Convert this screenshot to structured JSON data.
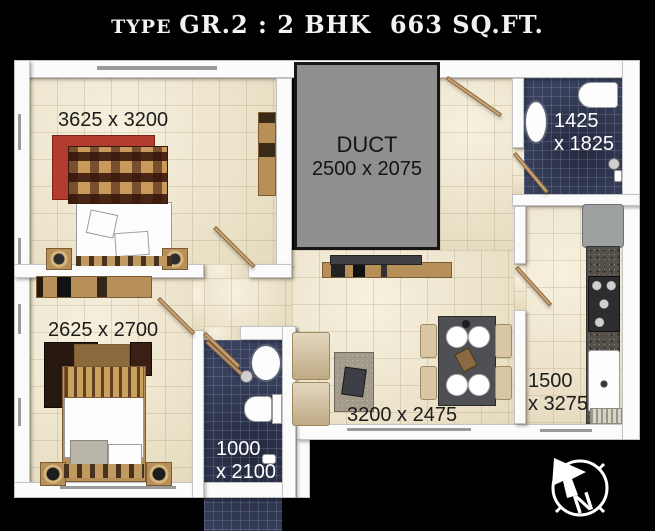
{
  "title": {
    "prefix": "TYPE ",
    "main": "GR.2 : 2 BHK  663 SQ.FT."
  },
  "rooms": {
    "bedroom1": {
      "dim": "3625 x 3200"
    },
    "duct": {
      "name": "DUCT",
      "dim": "2500 x 2075"
    },
    "bathroom1": {
      "dim_line1": "1425",
      "dim_line2": "x 1825"
    },
    "kitchen": {
      "dim_line1": "1500",
      "dim_line2": "x 3275"
    },
    "bedroom2": {
      "dim": "2625 x 2700"
    },
    "bathroom2": {
      "dim_line1": "1000",
      "dim_line2": "x 2100"
    },
    "living_dining": {
      "dim": "3200 x 2475"
    }
  },
  "compass": {
    "north_label": "N"
  },
  "colors": {
    "background": "#000000",
    "wall": "#fbfbfb",
    "floor_tile": "#ece3ca",
    "bath_tile": "#38405c",
    "duct_fill": "#8f8f8f",
    "label_dark": "#1c1c1c",
    "label_light": "#ffffff",
    "wood": "#b78f58",
    "rug_red": "#b23c30"
  }
}
